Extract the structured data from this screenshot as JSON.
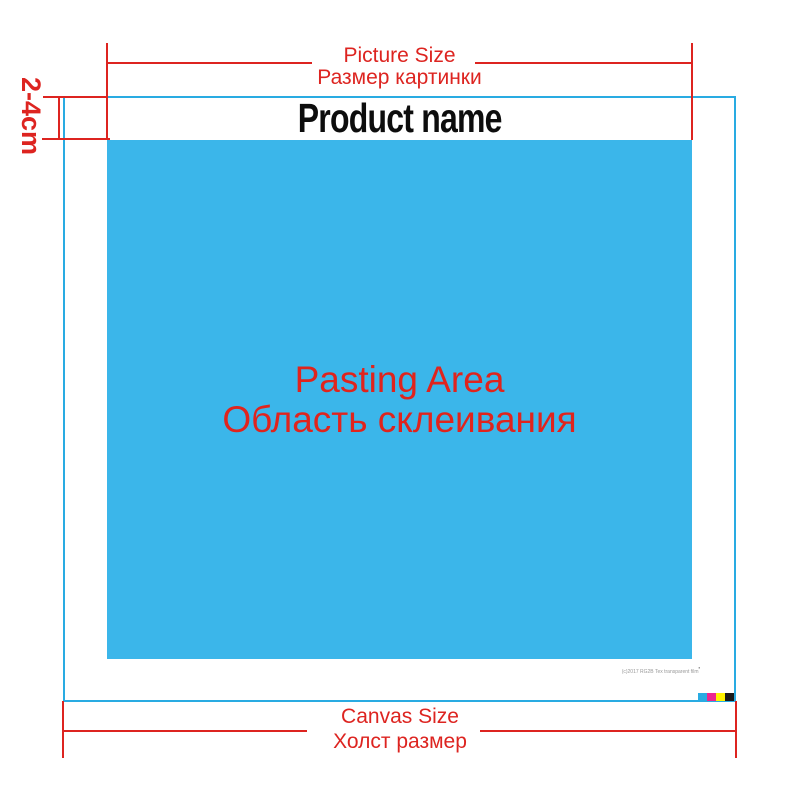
{
  "colors": {
    "dimension_red": "#DD2420",
    "pasting_blue": "#3BB6EA",
    "canvas_outline_cyan": "#29ABE2",
    "product_name_black": "#0d0d0d",
    "fine_print_gray": "#999999",
    "swatch_cyan": "#29ABE2",
    "swatch_magenta": "#EC268F",
    "swatch_yellow": "#FFF200",
    "swatch_black": "#1A1A1A"
  },
  "top_dimension": {
    "label_en": "Picture Size",
    "label_ru": "Размер картинки"
  },
  "left_dimension": {
    "label": "2-4cm"
  },
  "product": {
    "name": "Product name"
  },
  "pasting_area": {
    "label_en": "Pasting Area",
    "label_ru": "Область склеивания"
  },
  "bottom_dimension": {
    "label_en": "Canvas Size",
    "label_ru": "Холст размер"
  },
  "fine_print": {
    "text": "(c)2017 RG2B Tex transparent film",
    "mark": "▪"
  },
  "color_bar": {
    "swatches": [
      "cyan",
      "magenta",
      "yellow",
      "black"
    ]
  }
}
